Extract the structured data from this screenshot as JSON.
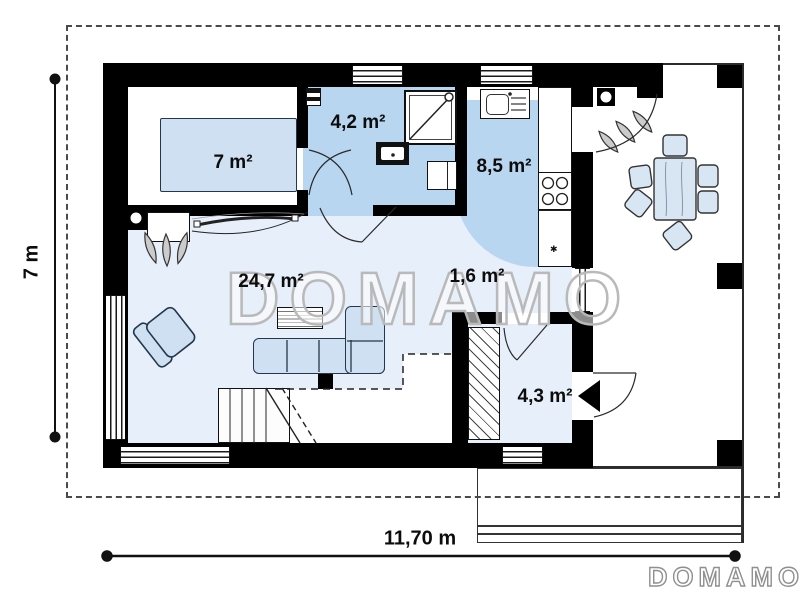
{
  "plan": {
    "watermark": "DOMAMO",
    "brand": "DOMAMO",
    "dimensions": {
      "width_label": "11,70 m",
      "height_label": "7 m"
    },
    "rooms": [
      {
        "name": "bedroom",
        "area": "7 m²"
      },
      {
        "name": "bathroom",
        "area": "4,2 m²"
      },
      {
        "name": "kitchen",
        "area": "8,5 m²"
      },
      {
        "name": "living-room",
        "area": "24,7 m²"
      },
      {
        "name": "hall",
        "area": "1,6 m²"
      },
      {
        "name": "wardrobe",
        "area": "4,3 m²"
      }
    ],
    "colors": {
      "wall": "#000000",
      "floor_light": "#e7effa",
      "floor_medium": "#b9d6f0",
      "furniture_fill": "#cfe0f3",
      "furniture_border": "#24364a",
      "watermark_outline": "#b9b9b9"
    }
  }
}
